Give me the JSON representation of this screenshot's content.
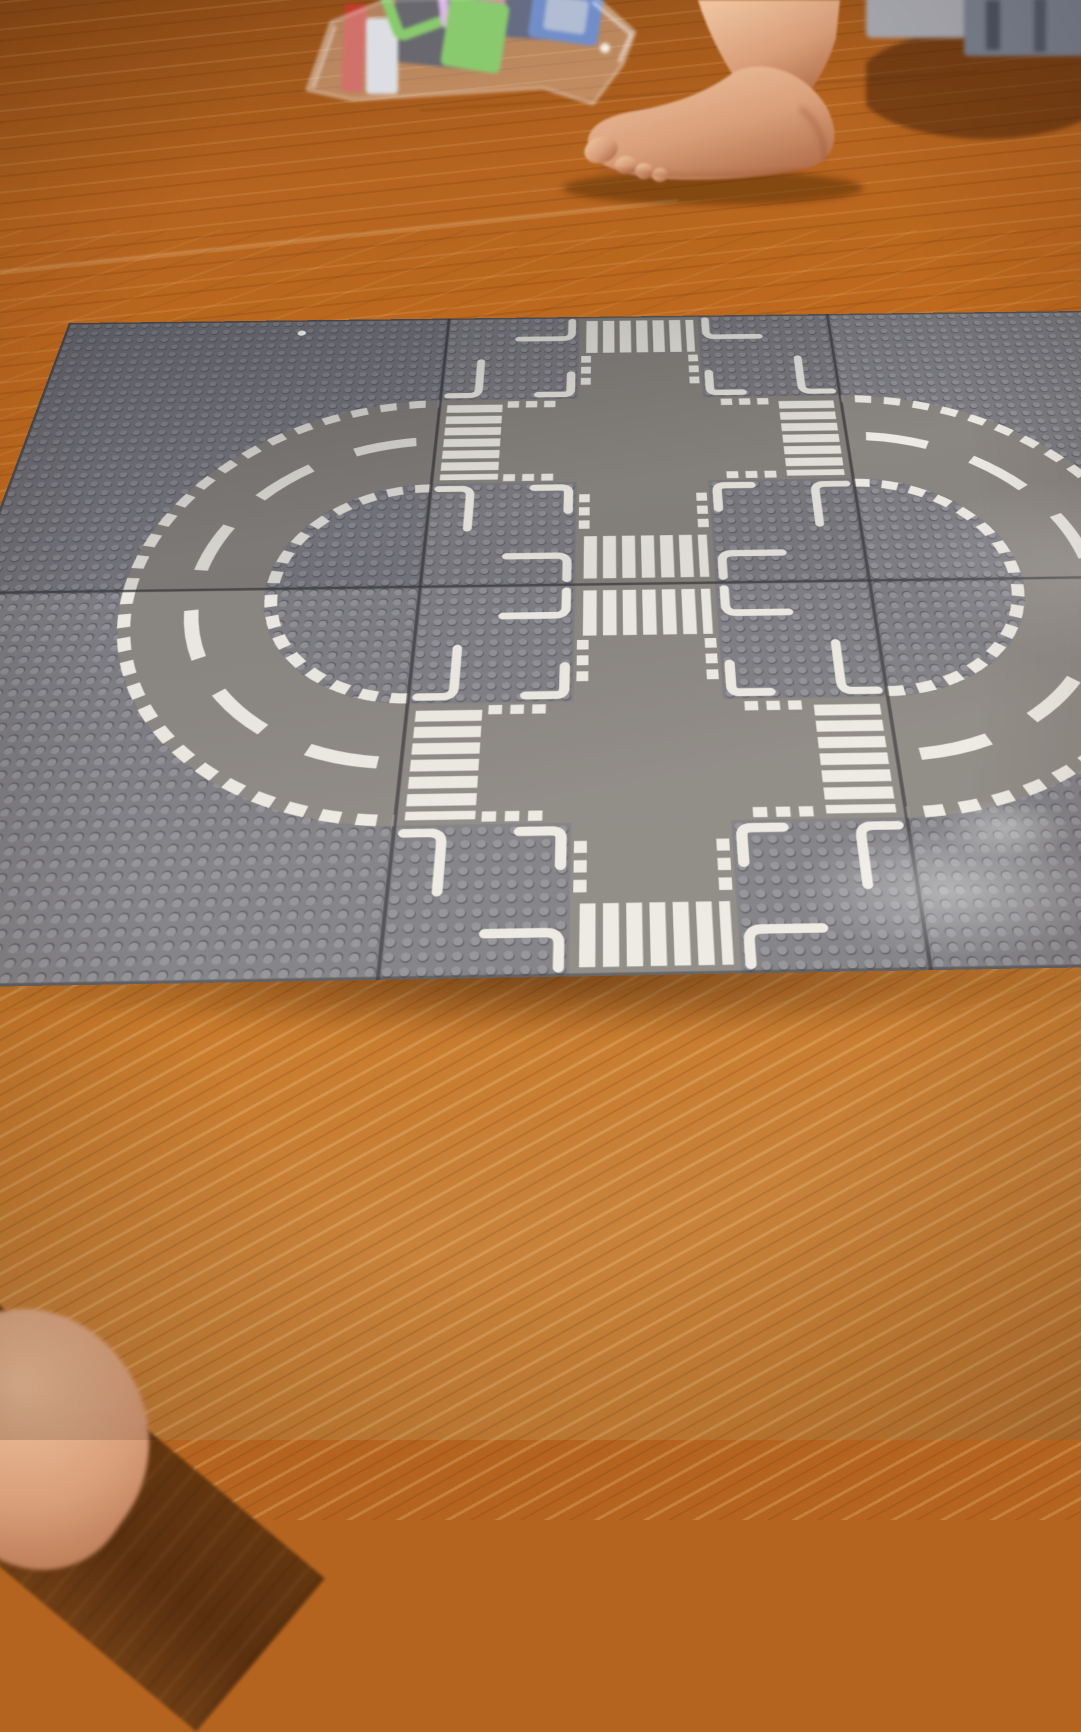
{
  "scene": {
    "description": "Photo taken from above of gray LEGO road baseplates assembled on an orange-brown wooden floor: two curved plates on the left form a half-circle road, two crossroad plates in the middle have white zebra crossings around plain intersection squares, and two more curved plates on the right form a second half-circle that runs off the right edge. A bare foot and a clear plastic bag of colorful magnetic tiles sit at the top; a dark floor plank and part of a knee appear at the bottom-left corner.",
    "objects": [
      {
        "name": "curved-road-baseplate-top-left",
        "type": "lego-baseplate"
      },
      {
        "name": "curved-road-baseplate-bottom-left",
        "type": "lego-baseplate"
      },
      {
        "name": "crossroad-baseplate-top-center",
        "type": "lego-baseplate"
      },
      {
        "name": "crossroad-baseplate-bottom-center",
        "type": "lego-baseplate"
      },
      {
        "name": "curved-road-baseplate-top-right",
        "type": "lego-baseplate"
      },
      {
        "name": "curved-road-baseplate-bottom-right",
        "type": "lego-baseplate"
      },
      {
        "name": "bare-foot",
        "type": "person"
      },
      {
        "name": "bag-of-magnetic-tiles",
        "type": "toy"
      },
      {
        "name": "blurry-objects-top-right",
        "type": "background"
      },
      {
        "name": "knee",
        "type": "person"
      },
      {
        "name": "wood-floor",
        "type": "surface"
      }
    ]
  },
  "palette": {
    "wood_base": "#b5641f",
    "wood_mid": "#c97b2c",
    "wood_dark": "#8a4a16",
    "plank_dark": "#63360f",
    "plate_gray": "#7d7d82",
    "stud_top": "#8f9096",
    "stud_shadow": "#5c5c63",
    "road_gray": "#8a8681",
    "marking_white": "#eceae3",
    "seam_dark": "#39393d",
    "skin_light": "#eec29e",
    "skin_mid": "#d89e79",
    "skin_deep": "#b06c49",
    "bag_film": "#f4f4f8",
    "tile_green": "#5cb832",
    "tile_pink": "#cf9ed7",
    "tile_blue": "#3a62b4",
    "tile_navy": "#283250",
    "tile_red": "#c23a2c",
    "tile_white": "#d3d4d8",
    "tile_dark": "#2c2b31",
    "object_gray": "#a8a9b0",
    "object_slate": "#79808f"
  }
}
